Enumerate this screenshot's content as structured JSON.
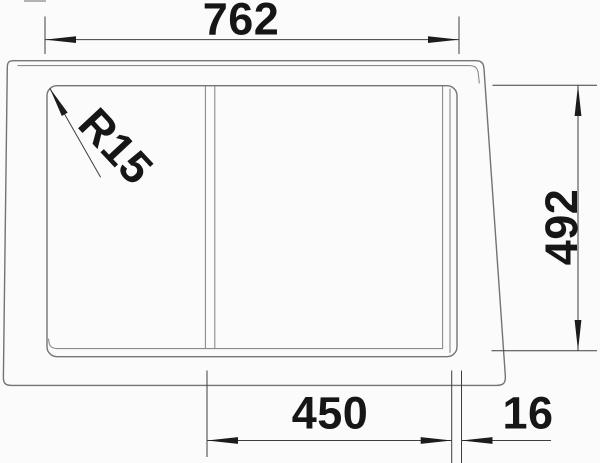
{
  "annotations": {
    "overall_width": "762",
    "overall_depth": "492",
    "bowl_width": "450",
    "rim_offset": "16",
    "corner_radius": "R15"
  },
  "colors": {
    "background": "#fbfbfb",
    "drawing_line": "#737373",
    "dimension_line": "#3e3e3e",
    "text": "#161616"
  }
}
